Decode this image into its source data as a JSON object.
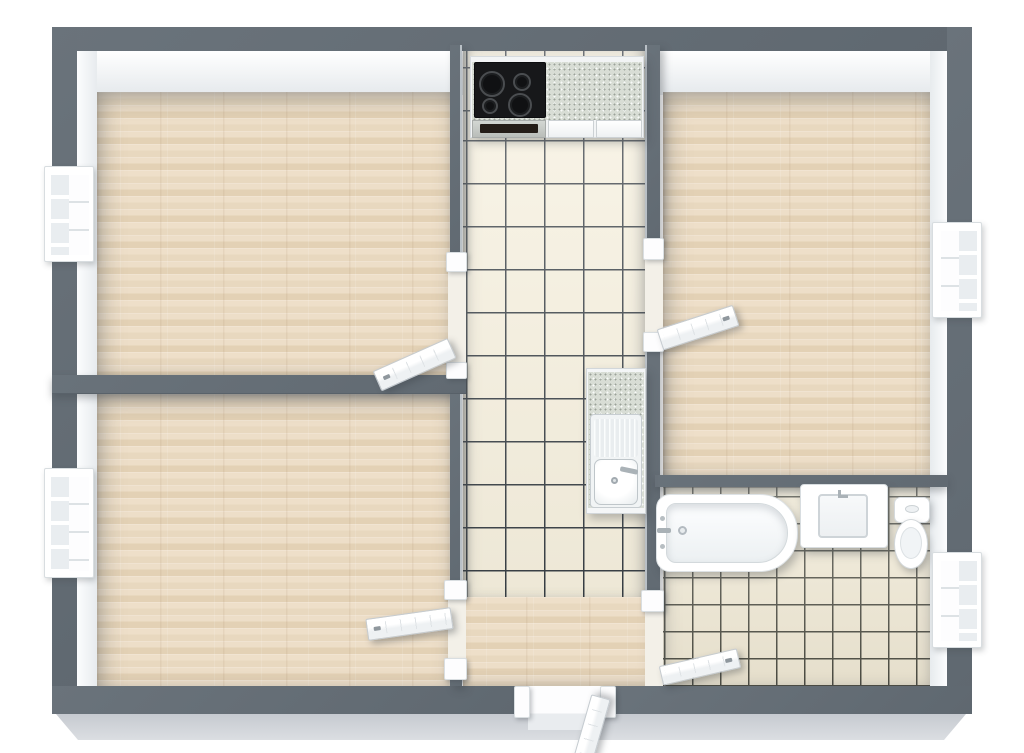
{
  "scene": {
    "type": "floor-plan-3d-top-view",
    "background": "#ffffff",
    "rooms": [
      {
        "id": "room-top-left",
        "floor": "wood",
        "windows": 1,
        "doors": [
          "to-kitchen-hall"
        ],
        "fixtures": []
      },
      {
        "id": "room-bottom-left",
        "floor": "wood",
        "windows": 1,
        "doors": [
          "to-hallway"
        ],
        "fixtures": []
      },
      {
        "id": "kitchen",
        "floor": "tile",
        "windows": 0,
        "doors": [
          "to-room-right",
          "open-to-hallway"
        ],
        "fixtures": [
          "cooktop",
          "oven-drawer",
          "countertop",
          "drawers",
          "sink-with-drainboard"
        ]
      },
      {
        "id": "room-right",
        "floor": "wood",
        "windows": 1,
        "doors": [
          "to-kitchen"
        ],
        "fixtures": []
      },
      {
        "id": "bathroom",
        "floor": "tile",
        "windows": 1,
        "doors": [
          "to-hallway"
        ],
        "fixtures": [
          "bathtub",
          "washbasin",
          "toilet"
        ]
      },
      {
        "id": "hallway",
        "floor": "wood",
        "windows": 0,
        "doors": [
          "entry-door"
        ],
        "fixtures": []
      }
    ],
    "counts": {
      "rooms": 6,
      "windows": 4,
      "interior_doors": 4,
      "entry_doors": 1,
      "burners_on_cooktop": 4
    }
  },
  "colors": {
    "wall": "#636c74",
    "wall_face": "#f4f6f8",
    "base_shadow": "#d3d6da",
    "wood_light": "#eedfc9",
    "wood_dark": "#e3d1b5",
    "kitchen_tile": "#f7f1df",
    "kitchen_grout": "#383f45",
    "bath_tile": "#efe8d4",
    "bath_grout": "#4e4e44",
    "counter": "#d8ddd5",
    "stove": "#17181a",
    "fixture_white": "#ffffff"
  }
}
